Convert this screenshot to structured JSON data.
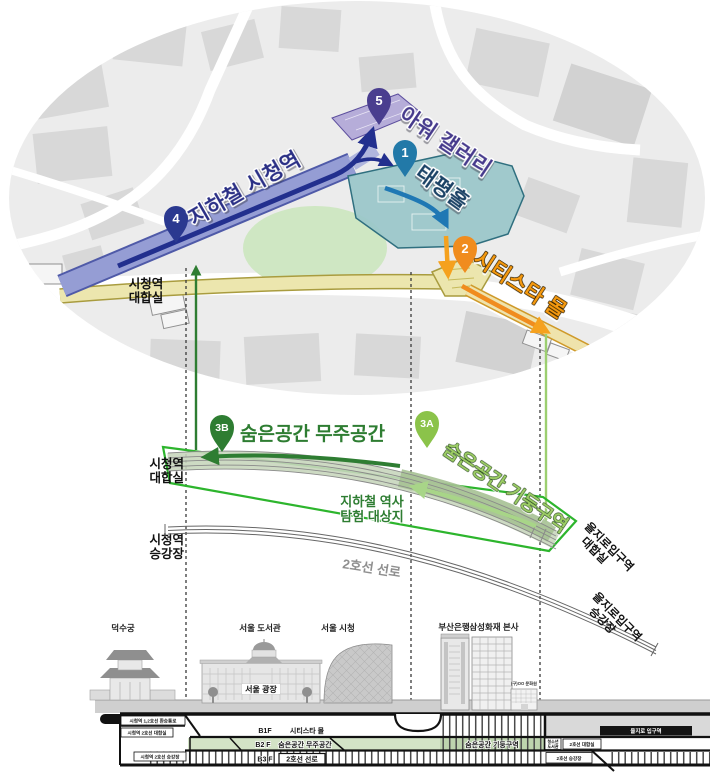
{
  "colors": {
    "route_navy": "#2b3990",
    "gallery_purple": "#4a3e8f",
    "hall_blue": "#2279a8",
    "mall_orange": "#f08c1e",
    "hidden_dark_green": "#2e7d32",
    "hidden_light_green": "#8bc34a",
    "frame_green": "#2db52d",
    "concourse_yellow": "#ece6ae",
    "lawn_green": "#cfe7c3"
  },
  "map": {
    "pins": [
      {
        "num": "5",
        "label": "아워 갤러리",
        "color": "#4a3e8f",
        "label_color": "#463a8c"
      },
      {
        "num": "1",
        "label": "태평홀",
        "color": "#2279a8",
        "label_color": "#1b4265"
      },
      {
        "num": "4",
        "label": "지하철 시청역",
        "color": "#2b3990",
        "label_color": "#2a2f85"
      },
      {
        "num": "2",
        "label": "시티스타 몰",
        "color": "#f08c1e",
        "label_color": "#f5990f"
      }
    ],
    "hall_label": [
      "시청역",
      "대합실"
    ]
  },
  "section": {
    "pins": [
      {
        "num": "3B",
        "label": "숨은공간 무주공간",
        "color": "#2e7d32",
        "label_color": "#2e7d32"
      },
      {
        "num": "3A",
        "label": "숨은공간 기둥구역",
        "color": "#8bc34a",
        "label_color": "#9ccc65"
      }
    ],
    "left_labels": [
      [
        "시청역",
        "대합실"
      ],
      [
        "시청역",
        "승강장"
      ]
    ],
    "note": [
      "지하철 역사",
      "탐험 대상지"
    ],
    "track": "2호선 선로",
    "right_labels": [
      [
        "을지로입구역",
        "대합실"
      ],
      [
        "을지로입구역",
        "승강장"
      ]
    ]
  },
  "skyline": {
    "deoksugung": "덕수궁",
    "library": "서울 도서관",
    "cityhall": "서울 시청",
    "plaza": "서울 광장",
    "busan_bank": "부산은행",
    "samsung": "삼성화재 본사",
    "small_bldg": "(구)OO 문화원"
  },
  "xsection": {
    "b1": {
      "level": "B1F",
      "label": "시티스타 몰"
    },
    "b2": {
      "level": "B2 F",
      "label": "숨은공간 무주공간"
    },
    "b3": {
      "level": "B3 F",
      "label": "2호선 선로"
    },
    "b2_right": "숨은공간 기둥구역",
    "left": [
      "시청역 1,2호선 환승통로",
      "시청역 2호선 대합실",
      "시청역 2호선 승강장"
    ],
    "right_station": "을지로 입구역",
    "right_box1": [
      "청소년",
      "도서관"
    ],
    "right_box2": "2호선 대합실",
    "right_box3": "2호선 승강장"
  }
}
